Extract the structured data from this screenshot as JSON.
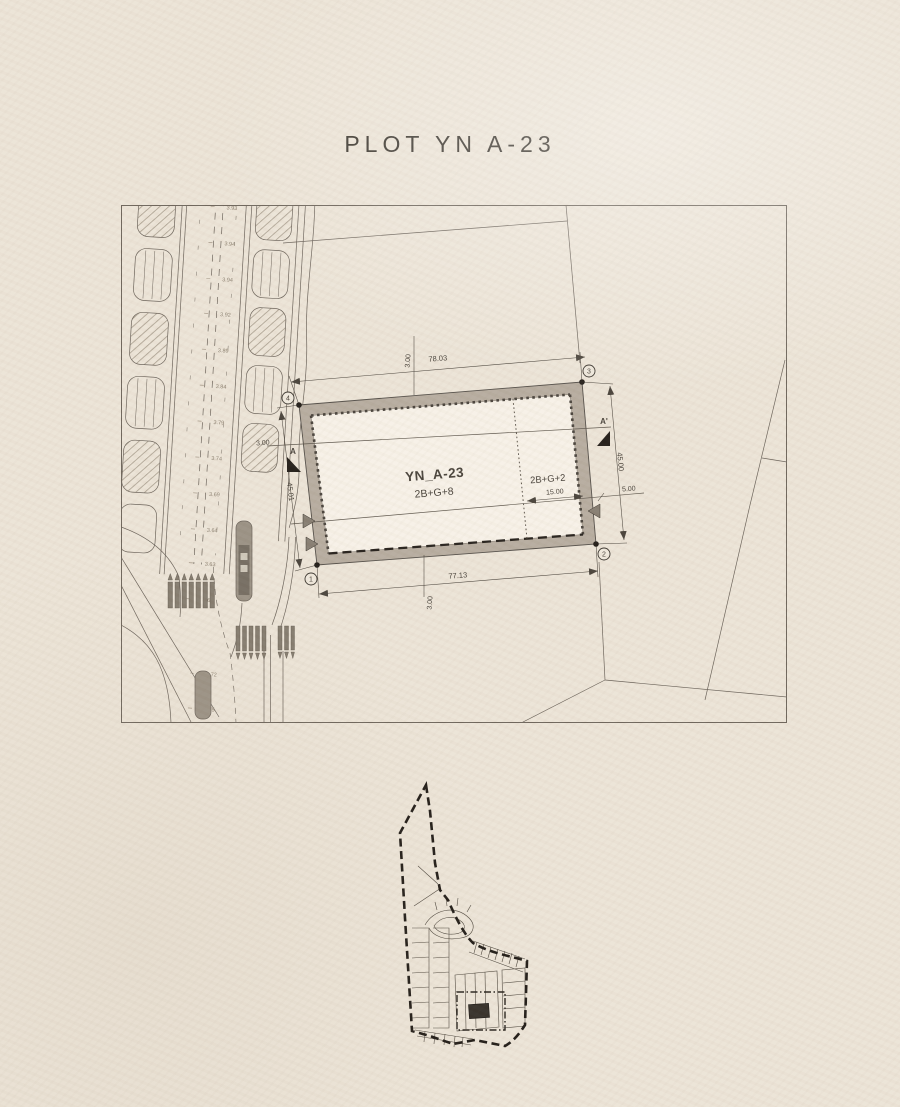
{
  "title": "PLOT YN A-23",
  "site_plan": {
    "plot": {
      "name": "YN_A-23",
      "storeys_main": "2B+G+8",
      "storeys_secondary": "2B+G+2"
    },
    "dimensions": {
      "top": "78.03",
      "bottom": "77.13",
      "left": "45.01",
      "right": "45.00",
      "secondary_depth": "15.00",
      "right_offset": "5.00",
      "top_setback": "3.00",
      "bottom_setback": "3.00",
      "left_setback": "3.00"
    },
    "corners": {
      "c1": "1",
      "c2": "2",
      "c3": "3",
      "c4": "4"
    },
    "section": {
      "start": "A",
      "end": "A'"
    },
    "road_levels": [
      "3.93",
      "3.94",
      "3.94",
      "3.92",
      "3.89",
      "3.84",
      "3.79",
      "3.74",
      "3.69",
      "3.64",
      "3.63",
      "3.65",
      "3.72",
      "3.75"
    ]
  },
  "colors": {
    "paper": "#ece4d7",
    "ink": "#5d564c",
    "plot_band": "#b7ada0",
    "plot_fill": "#f7f1e7",
    "highlight_dark": "#37312a",
    "island_gray": "#9b9285"
  }
}
